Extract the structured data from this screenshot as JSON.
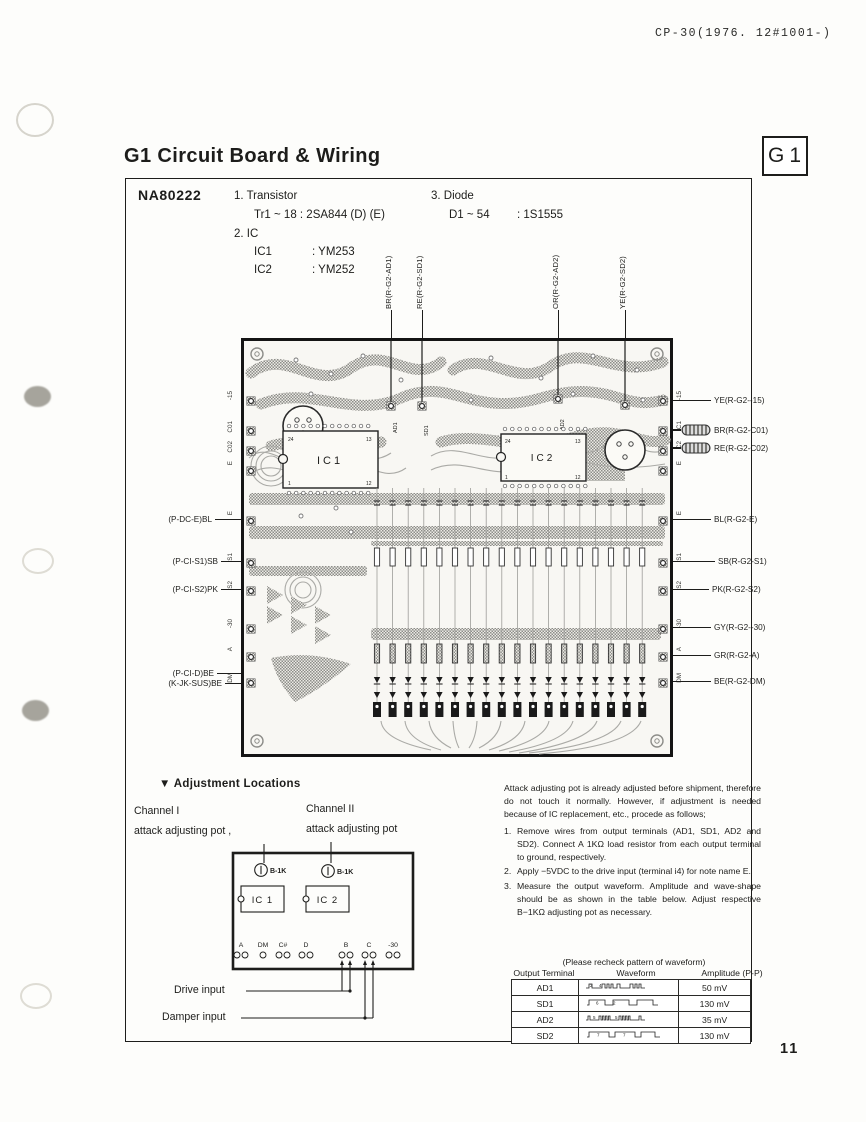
{
  "page": {
    "header_code": "CP-30(1976. 12#1001-)",
    "number": "11"
  },
  "title": {
    "text": "G1 Circuit Board & Wiring",
    "tag": "G1"
  },
  "parts_list": {
    "board_code": "NA80222",
    "item1": "1. Transistor",
    "item1_detail": "Tr1 ~ 18  : 2SA844 (D) (E)",
    "item2": "2. IC",
    "ic1": "IC1",
    "ic1_v": ": YM253",
    "ic2": "IC2",
    "ic2_v": ": YM252",
    "item3": "3. Diode",
    "item3_name": "D1 ~ 54",
    "item3_v": ": 1S1555"
  },
  "board": {
    "top_wire_labels": [
      "BR(R-G2-AD1)",
      "RE(R-G2-SD1)",
      "OR(R-G2-AD2)",
      "YE(R-G2-SD2)"
    ],
    "left_wire_labels": [
      "(P-DC-E)BL",
      "(P-CI-S1)SB",
      "(P-CI-S2)PK",
      "(P-CI-D)BE",
      "(K-JK-SUS)BE"
    ],
    "right_wire_labels": [
      "YE(R-G2--15)",
      "BR(R-G2-C01)",
      "RE(R-G2-C02)",
      "BL(R-G2-E)",
      "SB(R-G2-S1)",
      "PK(R-G2-S2)",
      "GY(R-G2--30)",
      "GR(R-G2-A)",
      "BE(R-G2-DM)"
    ],
    "left_edge": [
      "-15",
      "C01",
      "C02",
      "E",
      "E",
      "S1",
      "S2",
      "-30",
      "A",
      "DM"
    ],
    "right_edge": [
      "-15",
      "C1",
      "C2",
      "E",
      "E",
      "S1",
      "S2",
      "-30",
      "A",
      "DM"
    ],
    "ic1_label": "IC1",
    "ic2_label": "IC2",
    "dip_pins": [
      "24",
      "13",
      "1",
      "12"
    ],
    "inner_wire_marks": [
      "AD1",
      "SD1",
      "AD2"
    ]
  },
  "adjustment": {
    "marker": "▼",
    "heading": "Adjustment Locations",
    "channel1_line1": "Channel I",
    "channel1_line2": "attack adjusting pot ,",
    "channel2_line1": "Channel II",
    "channel2_line2": "attack adjusting pot",
    "pot_label": "B-1K",
    "ic1_label": "IC 1",
    "ic2_label": "IC 2",
    "terminals": [
      "A",
      "DM",
      "C#",
      "D",
      "B",
      "C",
      "-30"
    ],
    "drive_label": "Drive input",
    "damper_label": "Damper input"
  },
  "instructions": {
    "intro": "Attack adjusting pot is already adjusted before shipment, therefore do not touch it normally. However, if adjustment is needed because of IC replacement, etc., procede as follows;",
    "steps": [
      {
        "no": "1.",
        "text": "Remove wires from output terminals (AD1, SD1, AD2 and SD2). Connect A 1KΩ load resistor from each output terminal to ground, respectively."
      },
      {
        "no": "2.",
        "text": "Apply −5VDC to the drive input (terminal i4) for note name E."
      },
      {
        "no": "3.",
        "text": "Measure the output waveform. Amplitude and wave-shape should be as shown in the table below. Adjust respective B−1KΩ adjusting pot as necessary."
      }
    ]
  },
  "waveform_table": {
    "caption": "(Please recheck  pattern  of waveform)",
    "headers": {
      "terminal": "Output Terminal",
      "waveform": "Waveform",
      "amplitude": "Amplitude (P-P)"
    },
    "rows": [
      {
        "terminal": "AD1",
        "amplitude": "50 mV",
        "d1": "2",
        "d2": "4"
      },
      {
        "terminal": "SD1",
        "amplitude": "130 mV",
        "d1": "6",
        "d2": "2"
      },
      {
        "terminal": "AD2",
        "amplitude": "35 mV",
        "d1": "5",
        "d2": "5"
      },
      {
        "terminal": "SD2",
        "amplitude": "130 mV",
        "d1": "7",
        "d2": "7"
      }
    ]
  }
}
